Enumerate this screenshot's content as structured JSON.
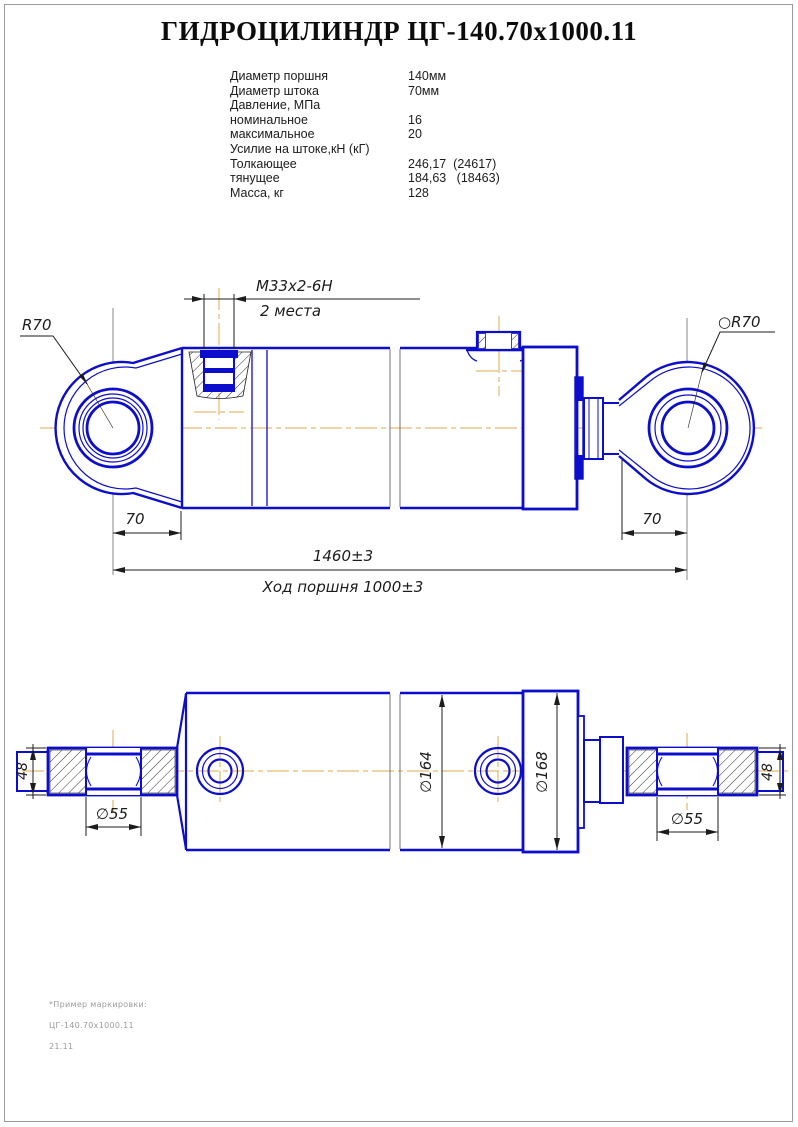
{
  "title": "ГИДРОЦИЛИНДР  ЦГ-140.70х1000.11",
  "specs": {
    "rows": [
      {
        "label": "Диаметр поршня",
        "value": "140мм"
      },
      {
        "label": "Диаметр штока",
        "value": "70мм"
      },
      {
        "label": "Давление, МПа",
        "value": ""
      },
      {
        "label": "номинальное",
        "value": "16"
      },
      {
        "label": "максимальное",
        "value": "20"
      },
      {
        "label": "Усилие на штоке,кН (кГ)",
        "value": ""
      },
      {
        "label": "Толкающее",
        "value": "246,17  (24617)"
      },
      {
        "label": "тянущее",
        "value": "184,63   (18463)"
      },
      {
        "label": "Масса, кг",
        "value": "128"
      }
    ]
  },
  "side_view": {
    "thread_label": "М33х2-6Н",
    "thread_note": "2 места",
    "left_radius_label": "R70",
    "right_radius_label": "○R70",
    "left_pivot_width": "70",
    "right_pivot_width": "70",
    "total_length": "1460±3",
    "stroke_label": "Ход поршня 1000±3"
  },
  "top_view": {
    "eye_width_left": "48",
    "eye_width_right": "48",
    "bore_left": "∅55",
    "bore_right": "∅55",
    "tube_diameter": "∅164",
    "head_diameter": "∅168"
  },
  "footnote": {
    "line1": "*Пример маркировки:",
    "line2": "ЦГ-140.70х1000.11",
    "line3": "21.11"
  },
  "colors": {
    "part_outline": "#0d0dcc",
    "centerline": "#dca94e",
    "dimension": "#1c1c1c"
  }
}
